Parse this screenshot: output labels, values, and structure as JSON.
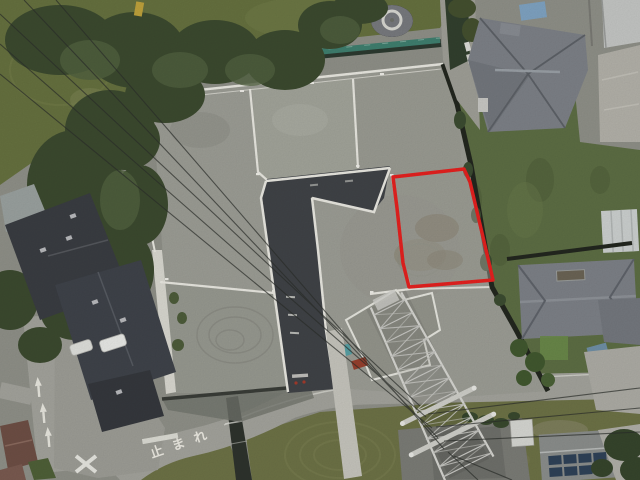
{
  "scene": {
    "type": "aerial-drone-photo",
    "description": "Aerial drone photo of a graded residential land subdivision; one vacant lot on the east side is outlined in red. A new asphalt access road runs through the lots, a transmission tower stands at the south-east, apartment buildings with dark roofs sit to the west, and tiled-roof houses border the east side.",
    "road_marking_text": "止まれ",
    "colors": {
      "base_ground": "#8f9088",
      "grass_field": "#66713f",
      "lawn_bottom": "#6d7246",
      "tree_dark": "#3c4a2f",
      "tree_light": "#516140",
      "fence_teal": "#3f7f6f",
      "parcel_gray": "#9c9d95",
      "asphalt": "#404347",
      "curb_white": "#e9e8e1",
      "red_outline": "#e5211f",
      "boundary_wall": "#23271f",
      "roof_dark": "#3a3d42",
      "roof_tile_gray": "#7d8187",
      "road_concrete": "#a3a39c",
      "channel_dark": "#2e332d",
      "tower_steel": "#d6d6d1",
      "solar_panel": "#2f4258",
      "tarp_blue": "#7fa3c2",
      "container_teal": "#58a0a4",
      "marking_white": "#e8e7df",
      "wire_dark": "#2c2f2b"
    }
  }
}
